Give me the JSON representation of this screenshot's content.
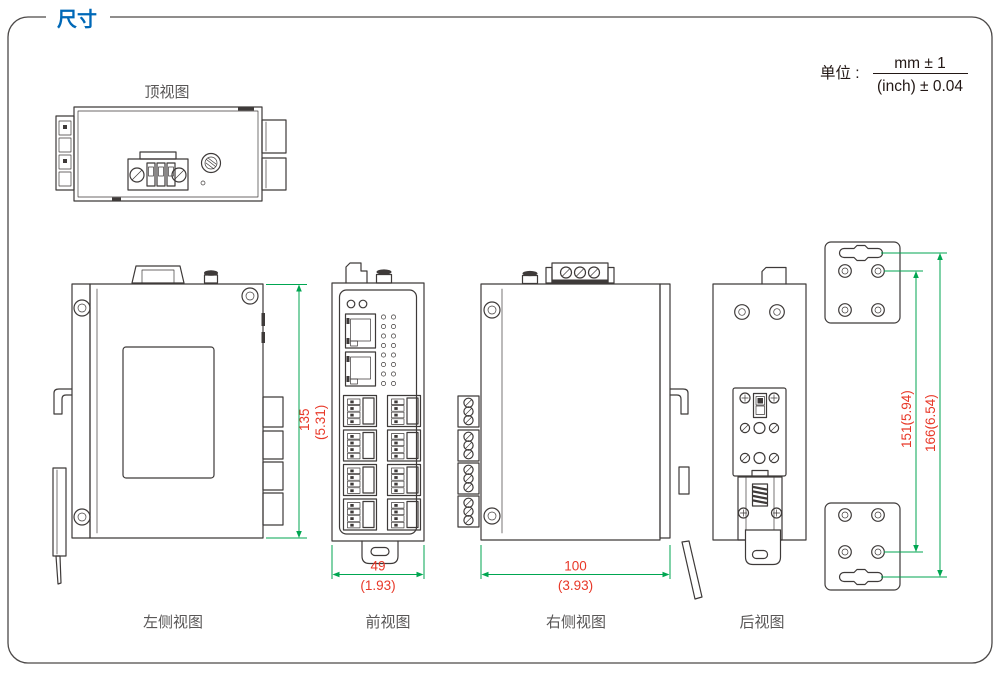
{
  "page": {
    "title": "尺寸"
  },
  "unit": {
    "label": "单位 :",
    "numerator": "mm ± 1",
    "denominator": "(inch) ± 0.04"
  },
  "views": {
    "top": {
      "label": "顶视图"
    },
    "left": {
      "label": "左侧视图"
    },
    "front": {
      "label": "前视图"
    },
    "right": {
      "label": "右侧视图"
    },
    "rear": {
      "label": "后视图"
    }
  },
  "dimensions": {
    "height_mm": "135",
    "height_inch": "(5.31)",
    "width_mm": "49",
    "width_inch": "(1.93)",
    "depth_mm": "100",
    "depth_inch": "(3.93)",
    "bracket_hole_span": "151(5.94)",
    "bracket_slot_span": "166(6.54)"
  },
  "colors": {
    "accent_blue": "#0068B7",
    "line_dark": "#3E3A39",
    "label_gray": "#595757",
    "dim_green": "#00A651",
    "dim_red": "#E83828",
    "frame_border": "#4C4948",
    "ink": "#231815",
    "background": "#FFFFFF"
  }
}
